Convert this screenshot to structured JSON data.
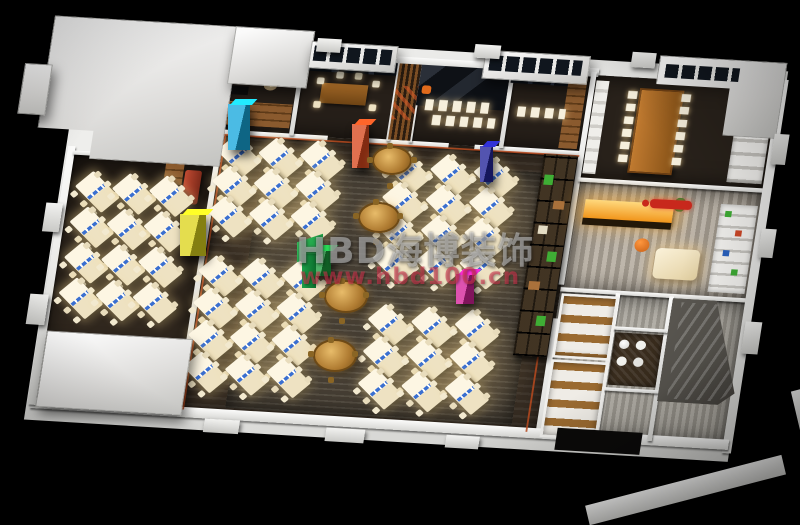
{
  "image": {
    "type": "3d-interior-render",
    "subject": "isometric cutaway floor plan of an open-plan office",
    "background_color": "#000000"
  },
  "watermark": {
    "brand": "HBD海博装饰",
    "url": "www.hbd100.cn",
    "brand_color": "rgba(246,246,246,0.42)",
    "url_color": "rgba(208,52,78,0.58)",
    "logo_color": "#1da04a"
  },
  "palette": {
    "walls": "#f2f2f0",
    "roof": "#e6e6e4",
    "open_office_floor": "#362c22",
    "carpet": "#4e463a",
    "desks": "#fdf6e3",
    "desk_accent_blue": "#3a6fd0",
    "round_table_bronze": "#b07c32",
    "reception_counter_glow": "#f5a623",
    "reception_wall_logo": "#c8281c",
    "pillars": {
      "cyan": "#18a8dc",
      "red": "#d8481e",
      "navy": "#23249a",
      "yellow": "#dcd41c",
      "green": "#1d9c3e",
      "magenta": "#d5219a"
    }
  }
}
